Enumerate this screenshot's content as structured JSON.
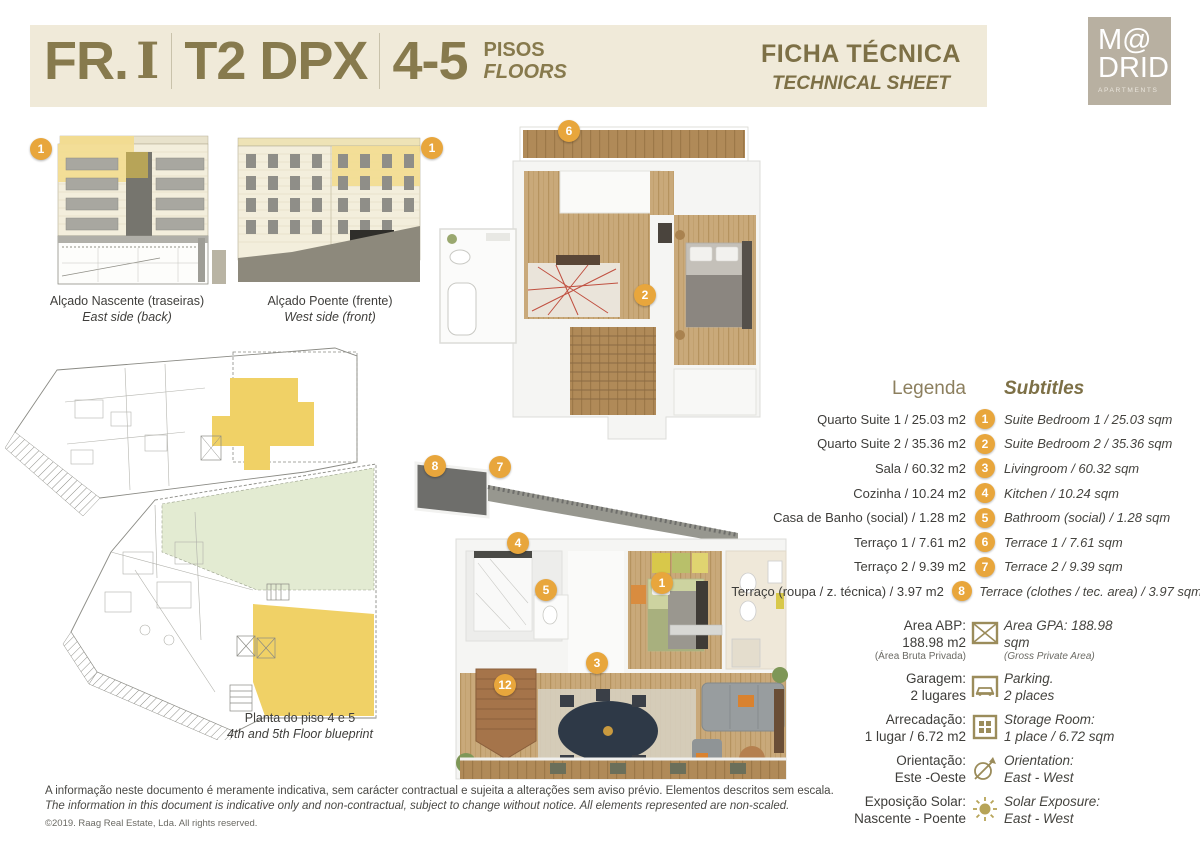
{
  "header": {
    "unit_prefix": "FR.",
    "unit_letter": "I",
    "unit_type": "T2 DPX",
    "floors_range": "4-5",
    "pisos_label": "PISOS",
    "floors_label": "FLOORS",
    "ficha_title": "FICHA TÉCNICA",
    "ficha_subtitle": "TECHNICAL SHEET",
    "logo": {
      "line1": "M@",
      "line2": "DRID.",
      "line3": "APARTMENTS"
    }
  },
  "elevations": {
    "items": [
      {
        "badge": "1",
        "caption_pt": "Alçado Nascente (traseiras)",
        "caption_en": "East side (back)"
      },
      {
        "badge": "1",
        "caption_pt": "Alçado Poente (frente)",
        "caption_en": "West side (front)"
      }
    ]
  },
  "blueprint": {
    "caption_pt": "Planta do piso 4 e 5",
    "caption_en": "4th and 5th Floor blueprint"
  },
  "plans": {
    "upper_badges": [
      {
        "n": "6"
      },
      {
        "n": "2"
      }
    ],
    "lower_badges": [
      {
        "n": "8"
      },
      {
        "n": "7"
      },
      {
        "n": "4"
      },
      {
        "n": "5"
      },
      {
        "n": "1"
      },
      {
        "n": "3"
      },
      {
        "n": "12"
      }
    ]
  },
  "legend": {
    "title_pt": "Legenda",
    "title_en": "Subtitles",
    "rows": [
      {
        "n": "1",
        "pt": "Quarto Suite 1 / 25.03 m2",
        "en": "Suite Bedroom 1 / 25.03 sqm"
      },
      {
        "n": "2",
        "pt": "Quarto Suite 2 / 35.36 m2",
        "en": "Suite Bedroom 2 / 35.36 sqm"
      },
      {
        "n": "3",
        "pt": "Sala / 60.32 m2",
        "en": "Livingroom / 60.32 sqm"
      },
      {
        "n": "4",
        "pt": "Cozinha / 10.24 m2",
        "en": "Kitchen / 10.24 sqm"
      },
      {
        "n": "5",
        "pt": "Casa de Banho (social) / 1.28 m2",
        "en": "Bathroom (social) / 1.28 sqm"
      },
      {
        "n": "6",
        "pt": "Terraço 1 / 7.61 m2",
        "en": "Terrace 1 / 7.61 sqm"
      },
      {
        "n": "7",
        "pt": "Terraço 2 / 9.39 m2",
        "en": "Terrace 2 / 9.39 sqm"
      },
      {
        "n": "8",
        "pt": "Terraço (roupa / z. técnica) / 3.97 m2",
        "en": "Terrace (clothes / tec. area) / 3.97 sqm"
      }
    ]
  },
  "info": {
    "rows": [
      {
        "icon": "area-icon",
        "pt_lines": [
          "Area ABP:",
          "188.98 m2",
          "(Área Bruta Privada)"
        ],
        "en_lines": [
          "Area GPA: 188.98",
          "sqm",
          "(Gross Private Area)"
        ]
      },
      {
        "icon": "parking-icon",
        "pt_lines": [
          "Garagem:",
          "2 lugares"
        ],
        "en_lines": [
          "Parking.",
          "2 places"
        ]
      },
      {
        "icon": "storage-icon",
        "pt_lines": [
          "Arrecadação:",
          "1 lugar / 6.72 m2"
        ],
        "en_lines": [
          "Storage Room:",
          "1 place / 6.72 sqm"
        ]
      },
      {
        "icon": "compass-icon",
        "pt_lines": [
          "Orientação:",
          "Este -Oeste"
        ],
        "en_lines": [
          "Orientation:",
          "East - West"
        ]
      },
      {
        "icon": "sun-icon",
        "pt_lines": [
          "Exposição Solar:",
          "Nascente - Poente"
        ],
        "en_lines": [
          "Solar Exposure:",
          "East - West"
        ]
      }
    ]
  },
  "disclaimer": {
    "pt": "A informação neste documento é meramente indicativa, sem carácter contractual e sujeita a alterações sem aviso prévio. Elementos descritos sem escala.",
    "en": "The information in this document is indicative only and non-contractual, subject to change without notice. All elements represented are non-scaled.",
    "copyright": "©2019. Raag Real Estate, Lda. All rights reserved."
  },
  "colors": {
    "accent_olive": "#877a4d",
    "badge_orange": "#e8a63c",
    "band_beige": "#f0ead9",
    "logo_taupe": "#b8b0a1",
    "highlight_yellow": "#f0d166",
    "terrace_green": "#e3ebd2"
  }
}
